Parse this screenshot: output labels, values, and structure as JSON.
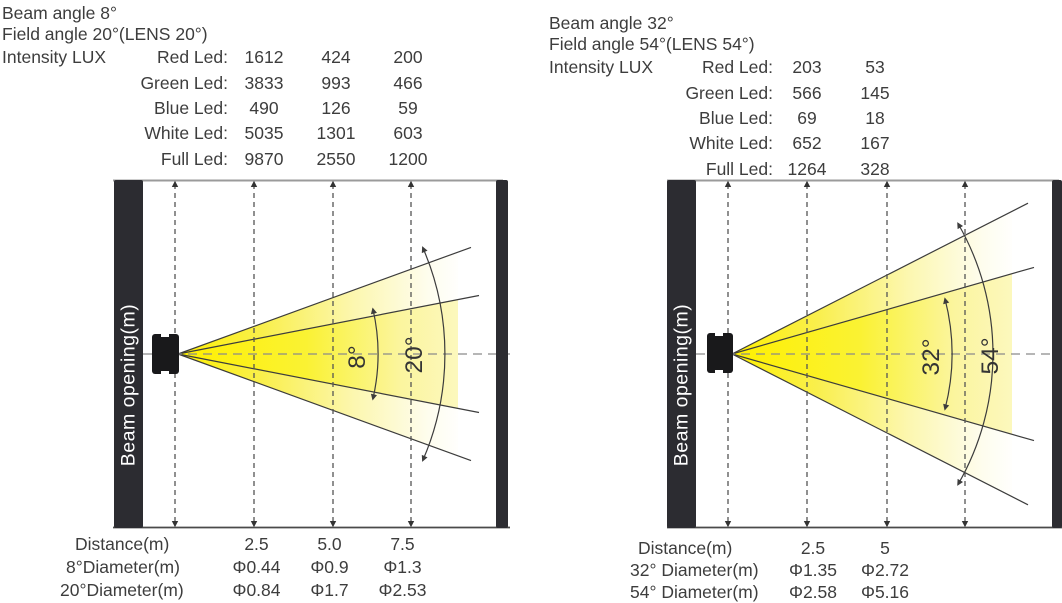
{
  "colors": {
    "beam_yellow": "#FFF000",
    "beam_fade": "#FFFFFF",
    "wall_dark": "#2C2C31",
    "text": "#3D3D3D",
    "line": "#3C3C3C"
  },
  "panels": [
    {
      "beam_angle": "Beam angle 8°",
      "field_angle": "Field angle 20°(LENS 20°)",
      "intensity_label": "Intensity LUX",
      "led_rows": [
        {
          "label": "Red Led:",
          "v": [
            "1612",
            "424",
            "200"
          ]
        },
        {
          "label": "Green Led:",
          "v": [
            "3833",
            "993",
            "466"
          ]
        },
        {
          "label": "Blue Led:",
          "v": [
            "490",
            "126",
            "59"
          ]
        },
        {
          "label": "White Led:",
          "v": [
            "5035",
            "1301",
            "603"
          ]
        },
        {
          "label": "Full Led:",
          "v": [
            "9870",
            "2550",
            "1200"
          ]
        }
      ],
      "axis_label": "Beam opening(m)",
      "inner_angle": "8°",
      "outer_angle": "20°",
      "distance_label": "Distance(m)",
      "distances": [
        "2.5",
        "5.0",
        "7.5"
      ],
      "diameter_rows": [
        {
          "label": "8°Diameter(m)",
          "v": [
            "Φ0.44",
            "Φ0.9",
            "Φ1.3"
          ]
        },
        {
          "label": "20°Diameter(m)",
          "v": [
            "Φ0.84",
            "Φ1.7",
            "Φ2.53"
          ]
        }
      ]
    },
    {
      "beam_angle": "Beam angle 32°",
      "field_angle": "Field angle 54°(LENS 54°)",
      "intensity_label": "Intensity LUX",
      "led_rows": [
        {
          "label": "Red Led:",
          "v": [
            "203",
            "53"
          ]
        },
        {
          "label": "Green Led:",
          "v": [
            "566",
            "145"
          ]
        },
        {
          "label": "Blue Led:",
          "v": [
            "69",
            "18"
          ]
        },
        {
          "label": "White Led:",
          "v": [
            "652",
            "167"
          ]
        },
        {
          "label": "Full Led:",
          "v": [
            "1264",
            "328"
          ]
        }
      ],
      "axis_label": "Beam opening(m)",
      "inner_angle": "32°",
      "outer_angle": "54°",
      "distance_label": "Distance(m)",
      "distances": [
        "2.5",
        "5"
      ],
      "diameter_rows": [
        {
          "label": "32° Diameter(m)",
          "v": [
            "Φ1.35",
            "Φ2.72"
          ]
        },
        {
          "label": "54° Diameter(m)",
          "v": [
            "Φ2.58",
            "Φ5.16"
          ]
        }
      ]
    }
  ]
}
